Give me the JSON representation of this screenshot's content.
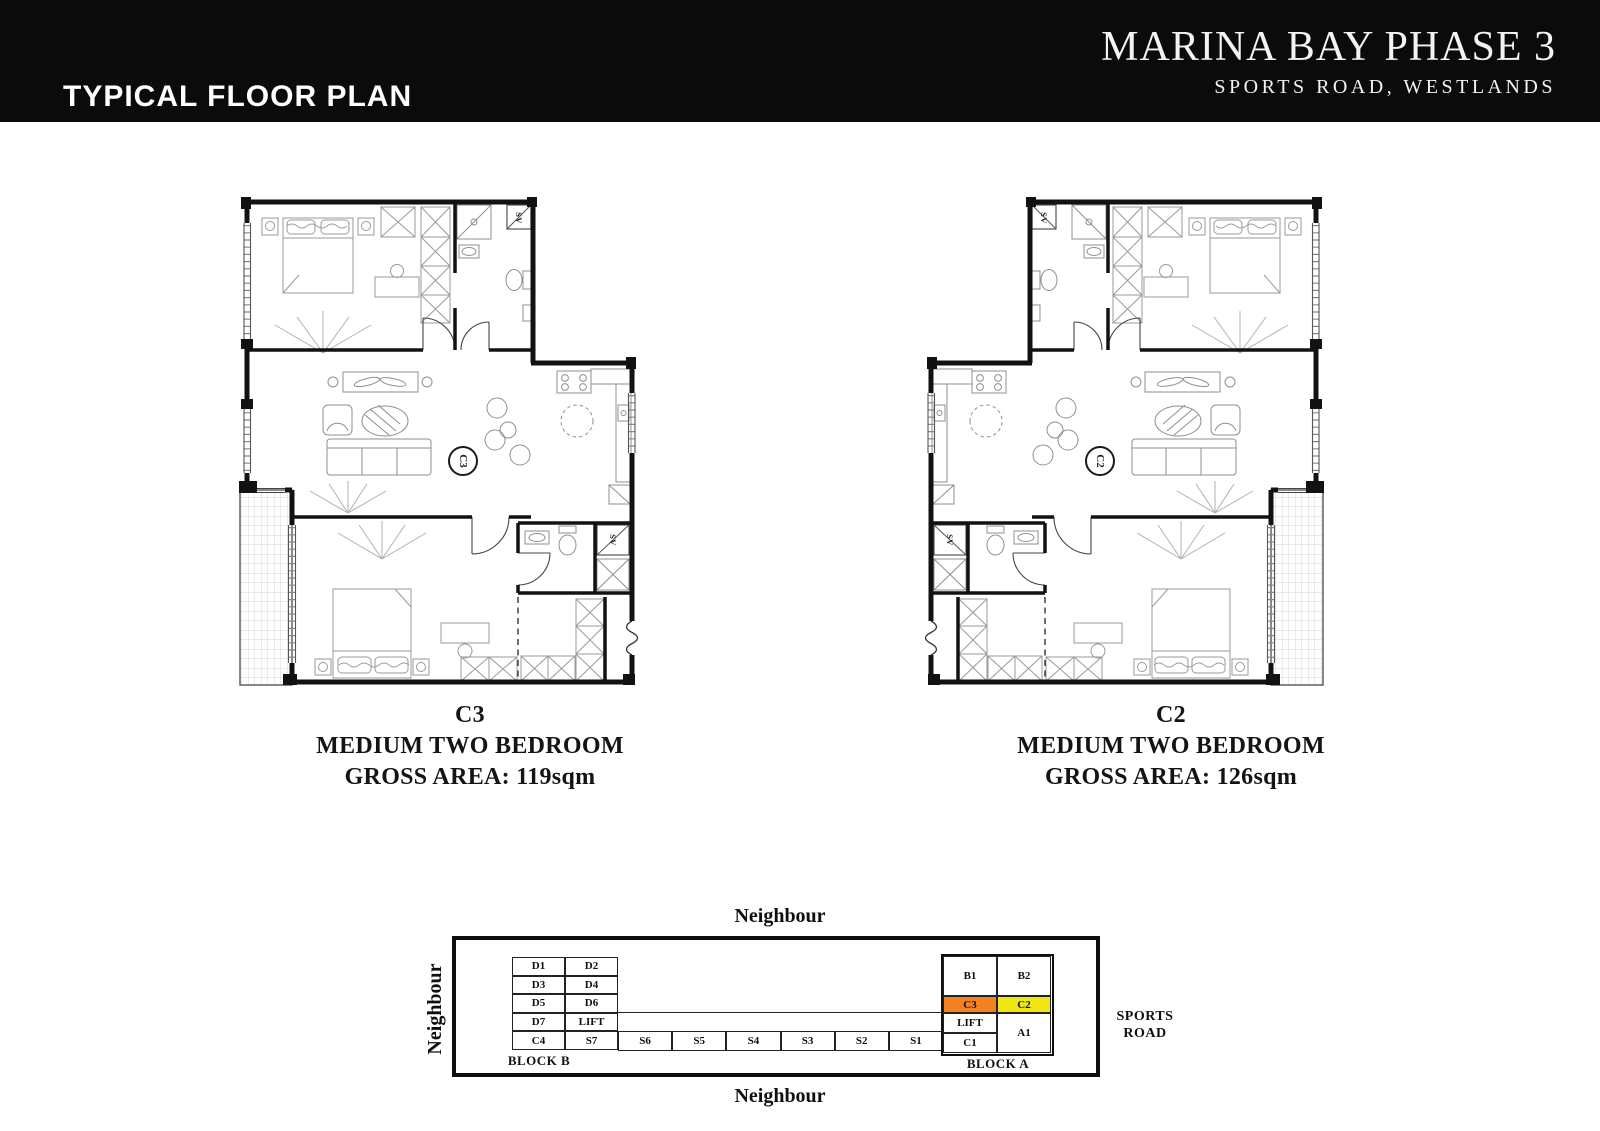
{
  "header": {
    "left_title": "TYPICAL FLOOR PLAN",
    "project_title": "MARINA BAY PHASE 3",
    "project_subtitle": "SPORTS ROAD, WESTLANDS"
  },
  "plans": {
    "c3": {
      "unit_circle_label": "C3",
      "caption_unit": "C3",
      "caption_type": "MEDIUM TWO BEDROOM",
      "caption_area": "GROSS AREA: 119sqm",
      "shaft_label_1": "SV",
      "shaft_label_2": "SV"
    },
    "c2": {
      "unit_circle_label": "C2",
      "caption_unit": "C2",
      "caption_type": "MEDIUM TWO BEDROOM",
      "caption_area": "GROSS AREA: 126sqm",
      "shaft_label_1": "SV",
      "shaft_label_2": "SV"
    }
  },
  "key_plan": {
    "neighbour_top": "Neighbour",
    "neighbour_bottom": "Neighbour",
    "neighbour_left": "Neighbour",
    "road_line1": "SPORTS",
    "road_line2": "ROAD",
    "block_b": {
      "label": "BLOCK B",
      "cells": [
        "D1",
        "D2",
        "D3",
        "D4",
        "D5",
        "D6",
        "D7",
        "LIFT",
        "C4",
        "S7"
      ]
    },
    "strip": [
      "S6",
      "S5",
      "S4",
      "S3",
      "S2",
      "S1"
    ],
    "block_a": {
      "label": "BLOCK A",
      "b1": "B1",
      "b2": "B2",
      "c3": "C3",
      "c2": "C2",
      "lift": "LIFT",
      "c1": "C1",
      "a1": "A1"
    },
    "colors": {
      "c3_highlight": "#F58220",
      "c2_highlight": "#F0E614"
    }
  }
}
